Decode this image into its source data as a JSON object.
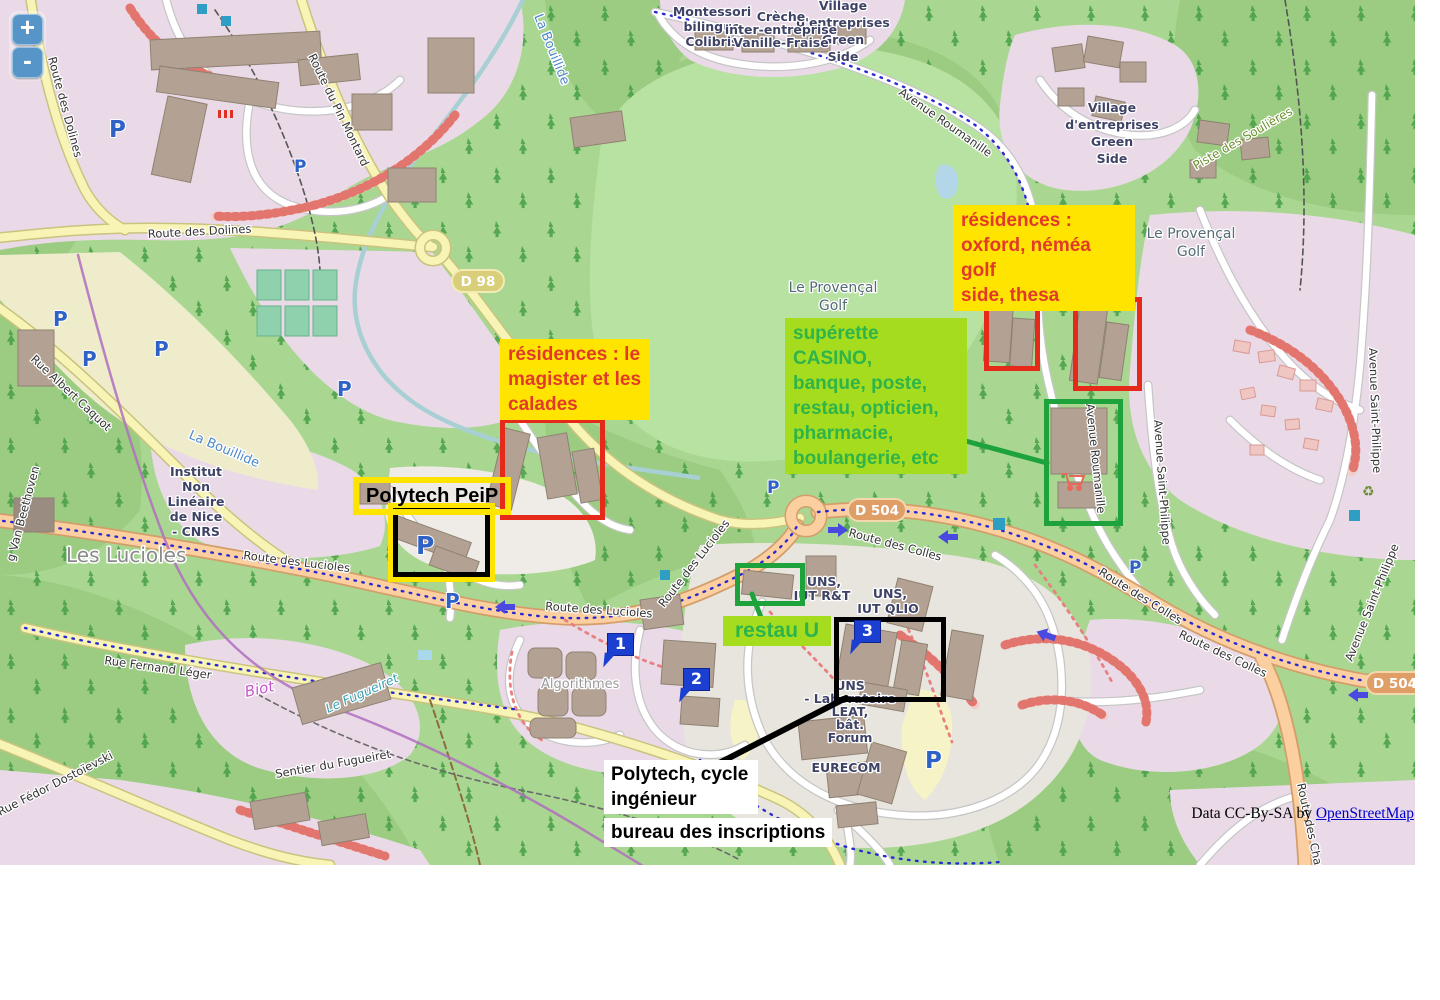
{
  "controls": {
    "zoom_in": "+",
    "zoom_out": "-"
  },
  "attribution": {
    "prefix": "Data CC-By-SA by ",
    "link_label": "OpenStreetMap"
  },
  "annotations": {
    "residences_oxford": "résidences :\noxford, néméa golf\nside, thesa",
    "residences_magister": "résidences : le\nmagister et les\ncalades",
    "superette": "supérette CASINO,\nbanque, poste,\nrestau, opticien,\npharmacie,\nboulangerie, etc",
    "restau_u": "restau U",
    "polytech_peip": "Polytech PeiP",
    "polytech_cycle": "Polytech, cycle\ningénieur",
    "bureau": "bureau des inscriptions"
  },
  "markers": [
    "1",
    "2",
    "3"
  ],
  "badges": {
    "d98": "D 98",
    "d504": "D 504"
  },
  "icons": {
    "parking": "P",
    "recycle": "♻"
  },
  "colors": {
    "annotation_yellow": "#ffe400",
    "annotation_red_text": "#e23a2a",
    "annotation_green_bg": "#a6dc1e",
    "annotation_green_text": "#2db44a",
    "frame_red": "#e52a1a",
    "frame_green": "#1ea33c",
    "frame_black": "#000000",
    "marker_blue": "#1b3fd0",
    "link_blue": "#0000cc"
  },
  "map_labels": {
    "route_des_dolines": "Route des Dolines",
    "route_du_pin_montard": "Route du Pin Montard",
    "rue_albert_caquot": "Rue Albert Caquot",
    "la_bouillide": "La Bouillide",
    "les_lucioles": "Les Lucioles",
    "institut": [
      "Institut",
      "Non",
      "Linéaire",
      "de Nice",
      "- CNRS"
    ],
    "route_des_lucioles": "Route des Lucioles",
    "rue_fernand_leger": "Rue Fernand Léger",
    "biot": "Biot",
    "le_fugueiret": "Le Fugueiret",
    "sentier_du_fugueiret": "Sentier du Fugueiret",
    "rue_fedor": "Rue Fédor Dostoïevski",
    "van_beethoven": "g Van Beethoven",
    "avenue_roumanille": "Avenue Roumanille",
    "provencal_golf": [
      "Le Provençal",
      "Golf"
    ],
    "village": [
      "Village",
      "d'entreprises",
      "Green",
      "Side"
    ],
    "montessori": [
      "Montessori",
      "bilingue",
      "Colibris"
    ],
    "creche": [
      "Crèche",
      "inter-entreprise",
      "Vanille-Fraise"
    ],
    "piste_des_soulieres": "Piste des Soulières",
    "uns_iut_rt": [
      "UNS,",
      "IUT R&T"
    ],
    "uns_iut_qlio": [
      "UNS,",
      "IUT QLIO"
    ],
    "uns_leat": [
      "UNS",
      "- Laboratoire",
      "LEAT,",
      "bât.",
      "Forum"
    ],
    "eurecom": "EURECOM",
    "algorithmes": "Algorithmes",
    "route_des_colles": "Route des Colles",
    "avenue_st_philippe": "Avenue Saint-Philippe",
    "route_des_chappes": "Route des Chappes"
  }
}
